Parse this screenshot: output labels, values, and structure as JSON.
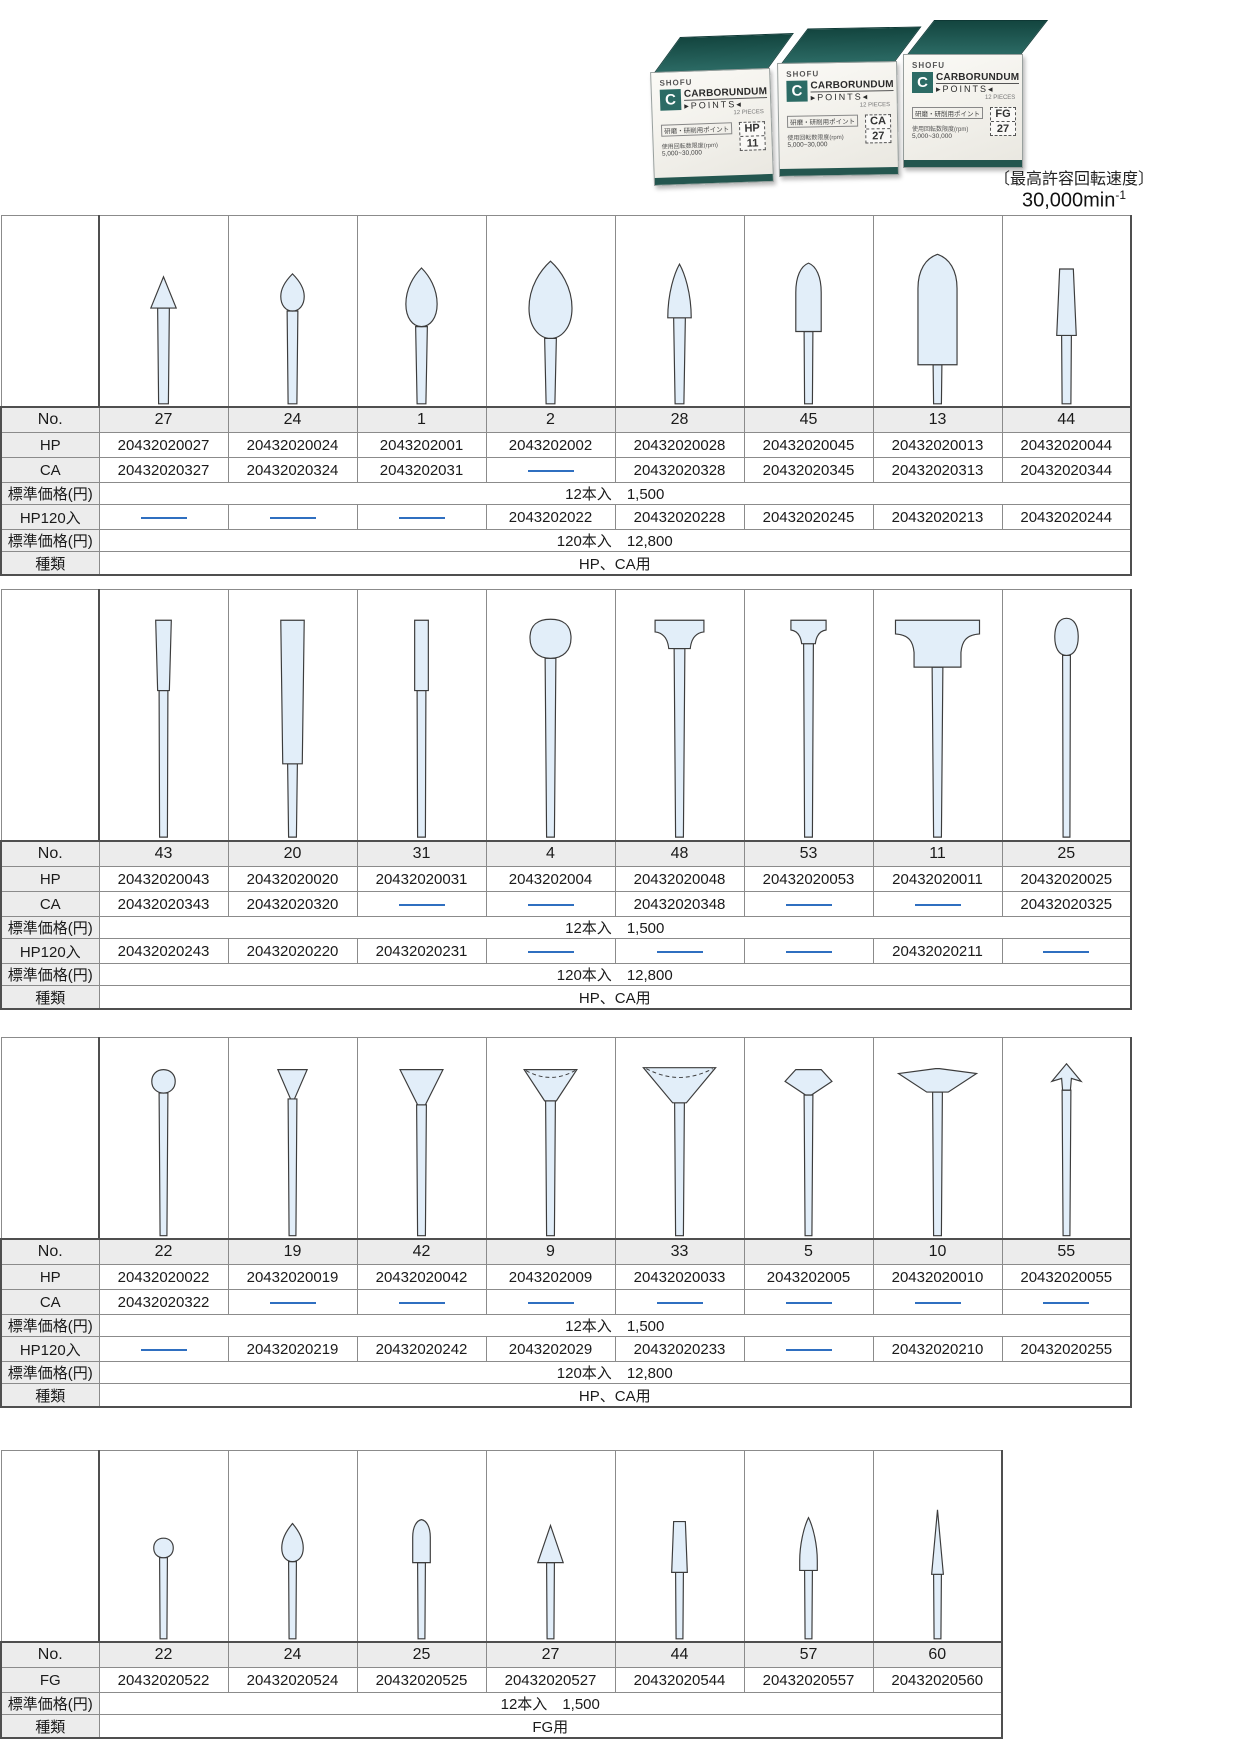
{
  "header": {
    "photo": {
      "brand": "SHOFU",
      "logo_letter": "C",
      "name1": "CARBORUNDUM",
      "name2": "POINTS",
      "pieces": "12 PIECES",
      "jp_line1": "研磨・研削用ポイント",
      "jp_line2": "使用回転数限度(rpm)",
      "jp_line3": "5,000~30,000",
      "boxes": [
        {
          "type": "HP",
          "no": "11"
        },
        {
          "type": "CA",
          "no": "27"
        },
        {
          "type": "FG",
          "no": "27"
        }
      ],
      "teal": "#2c6b65"
    },
    "speed_label": "〔最高許容回転速度〕",
    "speed_value": "30,000min",
    "speed_sup": "-1"
  },
  "colors": {
    "code_blue": "#2f6fc0",
    "shape_fill": "#e2eef9",
    "label_bg": "#ececec",
    "border_gray": "#4f4f4f"
  },
  "row_labels": {
    "no": "No.",
    "hp": "HP",
    "ca": "CA",
    "fg": "FG",
    "hp120": "HP120入",
    "price": "標準価格(円)",
    "kind": "種類"
  },
  "tables": [
    {
      "shapes": [
        "cone",
        "flame-small",
        "bud",
        "bud-large",
        "flame",
        "bullet",
        "bullet-large",
        "tapered-cylinder"
      ],
      "no": [
        "27",
        "24",
        "1",
        "2",
        "28",
        "45",
        "13",
        "44"
      ],
      "hp": [
        "20432020027",
        "20432020024",
        "2043202001",
        "2043202002",
        "20432020028",
        "20432020045",
        "20432020013",
        "20432020044"
      ],
      "ca": [
        "20432020327",
        "20432020324",
        "2043202031",
        "—",
        "20432020328",
        "20432020345",
        "20432020313",
        "20432020344"
      ],
      "hp120": [
        "—",
        "—",
        "—",
        "2043202022",
        "20432020228",
        "20432020245",
        "20432020213",
        "20432020244"
      ],
      "price12": {
        "qty": "12本入",
        "value": "1,500"
      },
      "price120": {
        "qty": "120本入",
        "value": "12,800"
      },
      "kind": "HP、CA用"
    },
    {
      "shapes": [
        "taper-short",
        "taper-long",
        "cylinder-small",
        "barrel",
        "t-head",
        "t-head-small",
        "t-head-wide",
        "egg"
      ],
      "no": [
        "43",
        "20",
        "31",
        "4",
        "48",
        "53",
        "11",
        "25"
      ],
      "hp": [
        "20432020043",
        "20432020020",
        "20432020031",
        "2043202004",
        "20432020048",
        "20432020053",
        "20432020011",
        "20432020025"
      ],
      "ca": [
        "20432020343",
        "20432020320",
        "—",
        "—",
        "20432020348",
        "—",
        "—",
        "20432020325"
      ],
      "hp120": [
        "20432020243",
        "20432020220",
        "20432020231",
        "—",
        "—",
        "—",
        "20432020211",
        "—"
      ],
      "price12": {
        "qty": "12本入",
        "value": "1,500"
      },
      "price120": {
        "qty": "120本入",
        "value": "12,800"
      },
      "kind": "HP、CA用"
    },
    {
      "shapes": [
        "ball",
        "inverted-cone-small",
        "inverted-cone",
        "cup",
        "cup-wide",
        "gem",
        "disc",
        "spear"
      ],
      "no": [
        "22",
        "19",
        "42",
        "9",
        "33",
        "5",
        "10",
        "55"
      ],
      "hp": [
        "20432020022",
        "20432020019",
        "20432020042",
        "2043202009",
        "20432020033",
        "2043202005",
        "20432020010",
        "20432020055"
      ],
      "ca": [
        "20432020322",
        "—",
        "—",
        "—",
        "—",
        "—",
        "—",
        "—"
      ],
      "hp120": [
        "—",
        "20432020219",
        "20432020242",
        "2043202029",
        "20432020233",
        "—",
        "20432020210",
        "20432020255"
      ],
      "price12": {
        "qty": "12本入",
        "value": "1,500"
      },
      "price120": {
        "qty": "120本入",
        "value": "12,800"
      },
      "kind": "HP、CA用"
    },
    {
      "shapes": [
        "ball-mini",
        "flame-mini",
        "bullet-mini",
        "cone-mini",
        "cylinder-mini",
        "taper-mini",
        "needle-mini"
      ],
      "no": [
        "22",
        "24",
        "25",
        "27",
        "44",
        "57",
        "60"
      ],
      "fg": [
        "20432020522",
        "20432020524",
        "20432020525",
        "20432020527",
        "20432020544",
        "20432020557",
        "20432020560"
      ],
      "price12": {
        "qty": "12本入",
        "value": "1,500"
      },
      "kind": "FG用"
    }
  ]
}
